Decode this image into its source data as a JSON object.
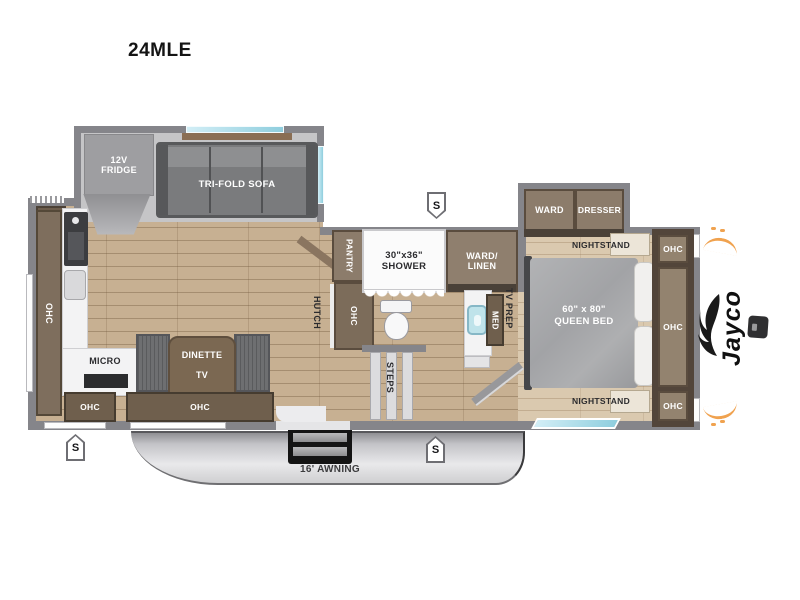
{
  "model": "24MLE",
  "brand": {
    "name": "Jayco"
  },
  "exterior": {
    "awning_label": "16' AWNING",
    "marker_label": "S"
  },
  "living": {
    "fridge": "12V FRIDGE",
    "sofa": "TRI-FOLD SOFA",
    "ohc_wall": "OHC",
    "micro": "MICRO",
    "dinette": "DINETTE",
    "dinette_tv": "TV",
    "ohc_bottom_small": "OHC",
    "ohc_bottom_long": "OHC",
    "hutch": "HUTCH",
    "hutch_ohc": "OHC",
    "pantry": "PANTRY"
  },
  "bath": {
    "shower_size": "30\"x36\"",
    "shower": "SHOWER",
    "ward_linen_line1": "WARD/",
    "ward_linen_line2": "LINEN",
    "med": "MED",
    "steps": "STEPS",
    "tv_prep": "TV PREP"
  },
  "bedroom": {
    "ward": "WARD",
    "dresser": "DRESSER",
    "nightstand_top": "NIGHTSTAND",
    "nightstand_bottom": "NIGHTSTAND",
    "bed_size": "60\" x 80\"",
    "bed_type": "QUEEN BED",
    "ohc_top": "OHC",
    "ohc_middle": "OHC",
    "ohc_bottom": "OHC"
  },
  "colors": {
    "wall": "#85858A",
    "wood_living": "#C7B092",
    "wood_bedroom": "#DAC9AF",
    "cabinet": "#8C7C6B",
    "cabinet_dark": "#5A4C3E",
    "counter": "#F3F3F4",
    "window_teal": "#8FCEDE",
    "accent_orange": "#F0A24F",
    "slide_floor": "#C5C5C7"
  }
}
